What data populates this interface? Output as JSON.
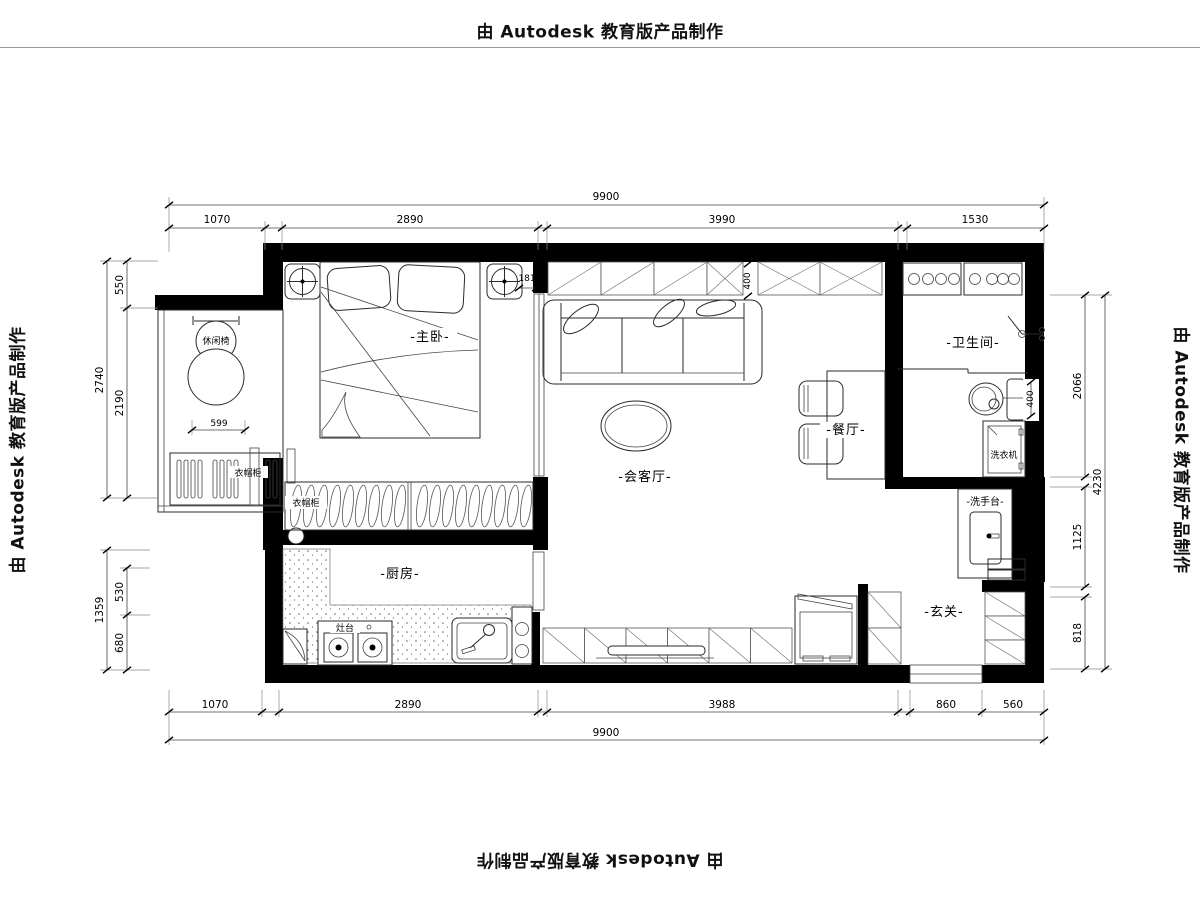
{
  "stamp": {
    "text": "由 Autodesk 教育版产品制作"
  },
  "labels": {
    "master_bedroom": "-主卧-",
    "living_room": "-会客厅-",
    "dining": "-餐厅-",
    "bathroom": "-卫生间-",
    "kitchen": "-厨房-",
    "entry": "-玄关-",
    "washstand": "-洗手台-",
    "leisure_chair": "休闲椅",
    "wardrobe_a": "衣帽柜",
    "wardrobe_b": "衣帽柜",
    "stove": "灶台",
    "washing_machine": "洗衣机"
  },
  "dims": {
    "top": {
      "overall": "9900",
      "segments": [
        "1070",
        "2890",
        "3990",
        "1530"
      ]
    },
    "bottom": {
      "overall": "9900",
      "segments": [
        "1070",
        "2890",
        "3988",
        "860",
        "560"
      ]
    },
    "left": {
      "outer": [
        "2740",
        "1359"
      ],
      "inner": [
        "550",
        "2190",
        "530",
        "680"
      ]
    },
    "right": {
      "outer": "4230",
      "inner": [
        "2066",
        "1125",
        "818"
      ]
    },
    "inline": {
      "chair": "599",
      "stub": "181",
      "cabinet_depth": "400",
      "toilet": "400"
    }
  },
  "colors": {
    "ink": "#000000",
    "background": "#ffffff"
  }
}
